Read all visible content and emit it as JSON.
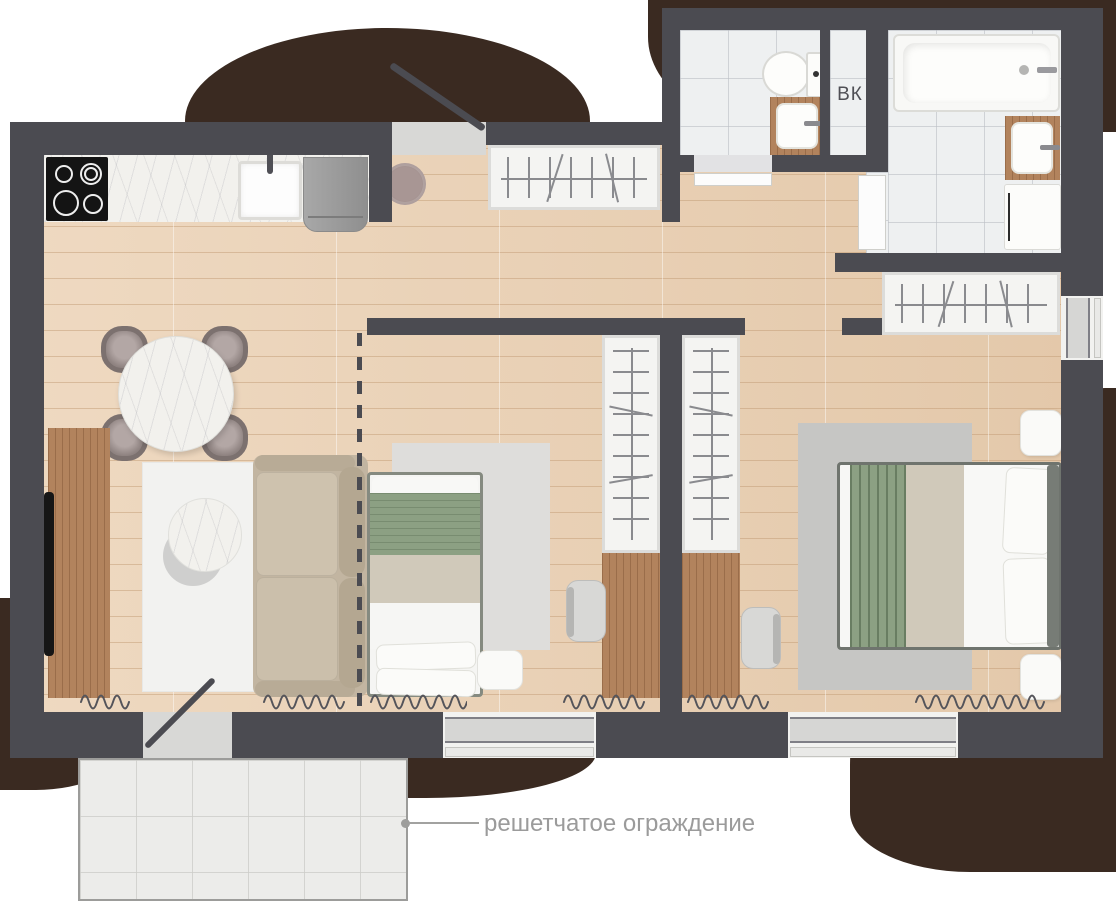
{
  "labels": {
    "shaft": "ВК",
    "fence": "решетчатое ограждение"
  },
  "colors": {
    "wall": "#4b4b51",
    "blob": "#3a2a21",
    "wood-floor": "#e9d0b5",
    "tile-floor": "#eef0f1",
    "balcony-tile": "#ececea",
    "rug-light": "#f2f2f0",
    "rug-gray": "#c6c6c4",
    "sofa": "#c2b5a1",
    "bed-green": "#8ca083",
    "bed-beige": "#d0c9ba",
    "wood-furniture": "#b2835d",
    "appliance-gray": "#9f9f9f",
    "radiator": "#54545a",
    "annotation": "#9b9b9b",
    "shaft-text": "#4f4f55"
  }
}
